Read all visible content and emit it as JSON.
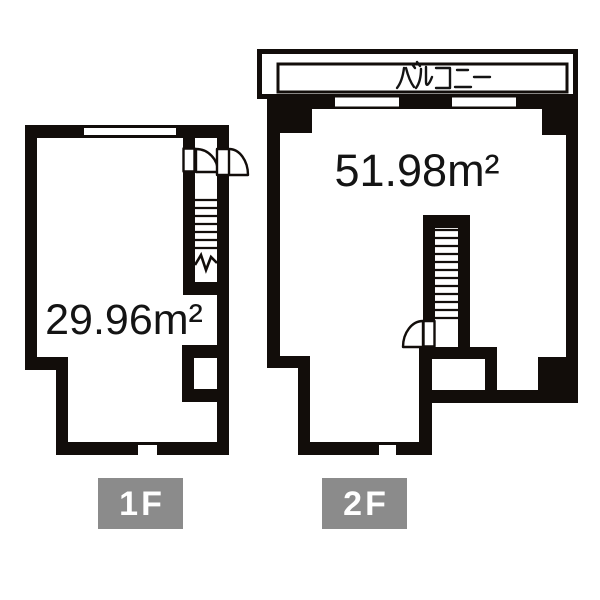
{
  "colors": {
    "background": "#ffffff",
    "wall": "#120d0a",
    "label_background": "#8b8b8b",
    "label_text": "#ffffff",
    "text": "#141414"
  },
  "floor1": {
    "label": "1F",
    "area": "29.96m²"
  },
  "floor2": {
    "label": "2F",
    "area": "51.98m²",
    "balcony_label": "バルコニー"
  }
}
